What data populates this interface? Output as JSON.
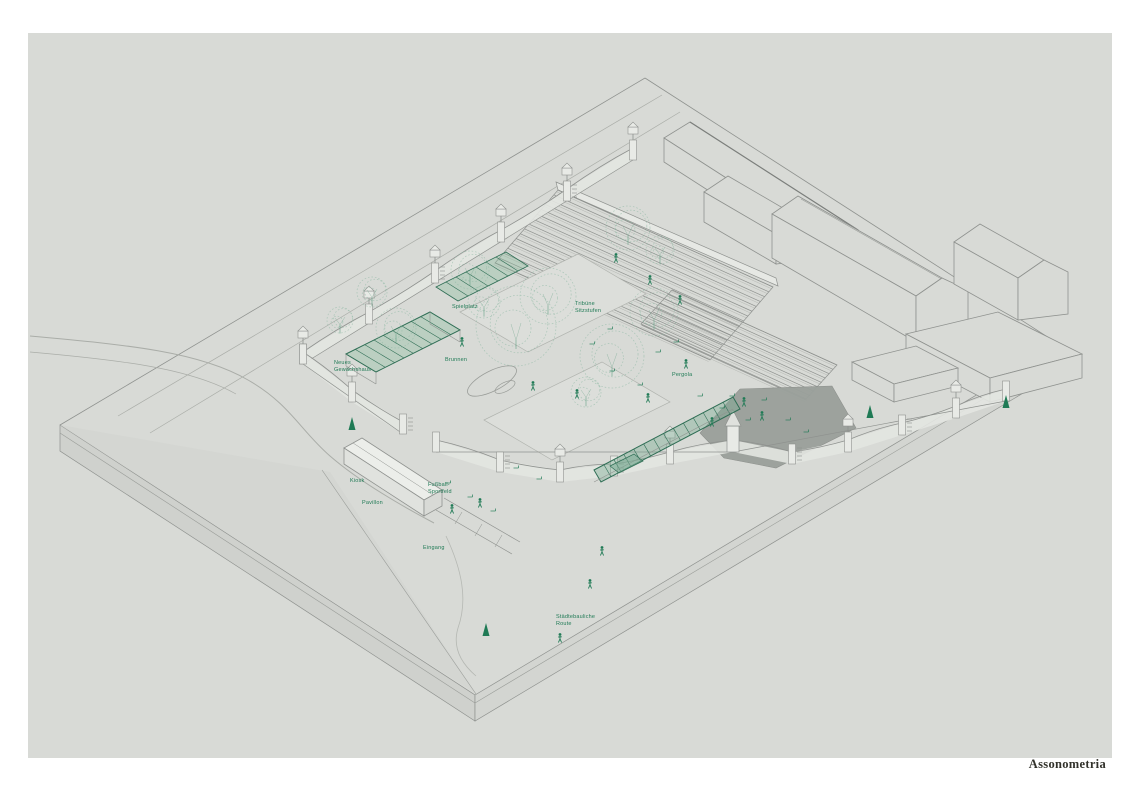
{
  "page": {
    "caption": "Assonometria"
  },
  "colors": {
    "paper": "#ffffff",
    "canvas": "#d8dad6",
    "slab_side": "#cfd1cd",
    "slab_side2": "#d3d5d1",
    "wedge": "#d2d4d0",
    "line": "#8f928f",
    "line_light": "#aaada8",
    "wall_fill": "#e3e5e1",
    "panel_fill": "#dcdeda",
    "plaza": "#9aa09b",
    "accent_green": "#1f7a55",
    "sketch_green": "#8bb8a2",
    "frame_green": "#2f6e55",
    "glass_green": "rgba(134,185,156,0.35)",
    "caption_ink": "#32322b"
  },
  "annotations": [
    {
      "x": 334,
      "y": 360,
      "lines": [
        "Neues",
        "Gewächshaus"
      ]
    },
    {
      "x": 445,
      "y": 357,
      "lines": [
        "Brunnen"
      ]
    },
    {
      "x": 452,
      "y": 304,
      "lines": [
        "Spielplatz"
      ]
    },
    {
      "x": 575,
      "y": 301,
      "lines": [
        "Tribüne",
        "Sitzstufen"
      ]
    },
    {
      "x": 672,
      "y": 372,
      "lines": [
        "Pergola"
      ]
    },
    {
      "x": 350,
      "y": 478,
      "lines": [
        "Kiosk"
      ]
    },
    {
      "x": 362,
      "y": 500,
      "lines": [
        "Pavillon"
      ]
    },
    {
      "x": 423,
      "y": 545,
      "lines": [
        "Eingang"
      ]
    },
    {
      "x": 428,
      "y": 482,
      "lines": [
        "Fußball-",
        "Sportfeld"
      ]
    },
    {
      "x": 556,
      "y": 614,
      "lines": [
        "Städtebauliche",
        "Route"
      ]
    }
  ]
}
